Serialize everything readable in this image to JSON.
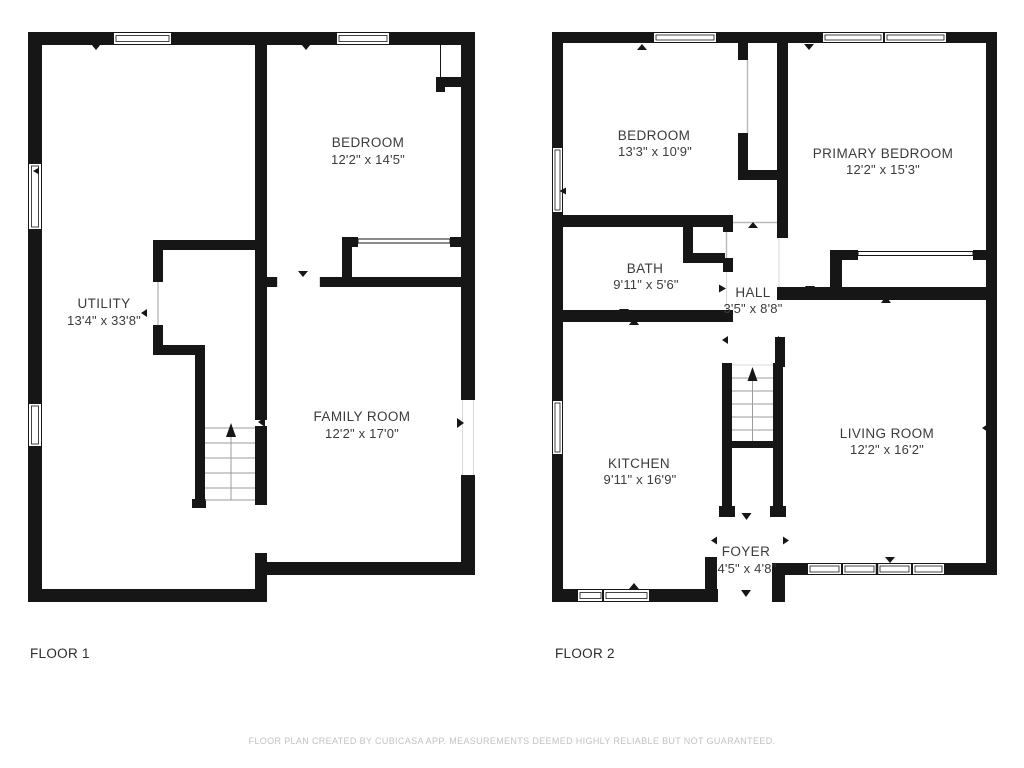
{
  "colors": {
    "wall": "#161616",
    "text": "#3b3b3b",
    "muted": "#c2c2c6",
    "tread": "#9b9b9b",
    "door": "#b9b9b9"
  },
  "footer": {
    "disclaimer": "FLOOR PLAN CREATED BY CUBICASA APP. MEASUREMENTS DEEMED HIGHLY RELIABLE BUT NOT GUARANTEED."
  },
  "floor1": {
    "label": "FLOOR 1",
    "rooms": [
      {
        "name": "BEDROOM",
        "dims": "12'2\" x 14'5\""
      },
      {
        "name": "UTILITY",
        "dims": "13'4\" x 33'8\""
      },
      {
        "name": "FAMILY ROOM",
        "dims": "12'2\" x 17'0\""
      }
    ]
  },
  "floor2": {
    "label": "FLOOR 2",
    "rooms": [
      {
        "name": "BEDROOM",
        "dims": "13'3\" x 10'9\""
      },
      {
        "name": "PRIMARY BEDROOM",
        "dims": "12'2\" x 15'3\""
      },
      {
        "name": "BATH",
        "dims": "9'11\" x 5'6\""
      },
      {
        "name": "HALL",
        "dims": "3'5\" x 8'8\""
      },
      {
        "name": "KITCHEN",
        "dims": "9'11\" x 16'9\""
      },
      {
        "name": "LIVING ROOM",
        "dims": "12'2\" x 16'2\""
      },
      {
        "name": "FOYER",
        "dims": "4'5\" x 4'8\""
      }
    ]
  }
}
